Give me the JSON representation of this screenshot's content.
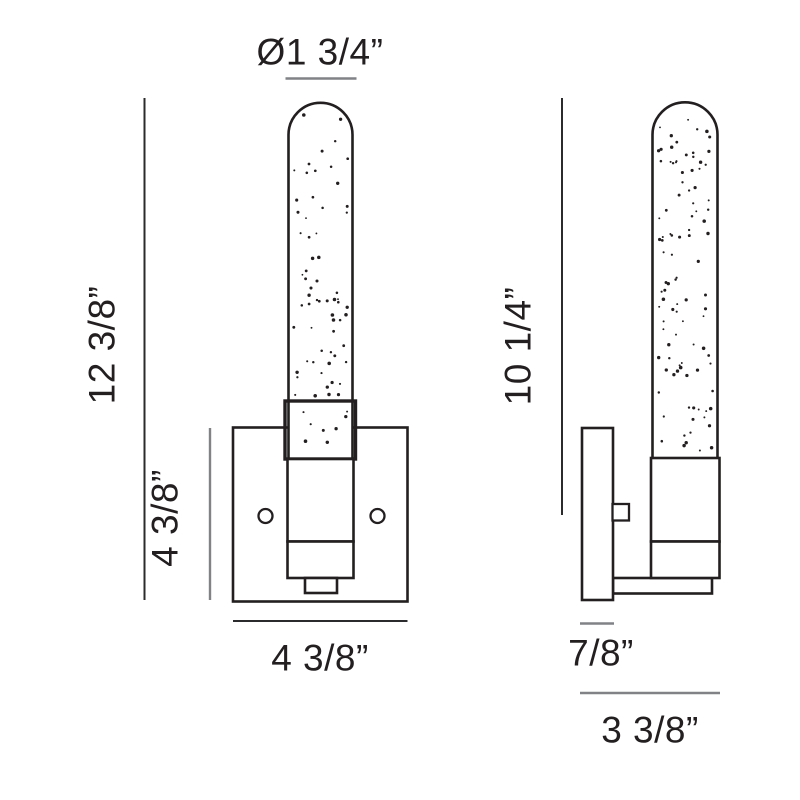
{
  "diagram": {
    "kind": "product-dimension-drawing",
    "subject": "wall-sconce-with-seeded-glass-cylinder",
    "labels": {
      "shade_diameter": "Ø1 3/4”",
      "overall_height": "12 3/8”",
      "backplate_height": "4 3/8”",
      "backplate_width": "4 3/8”",
      "shade_height": "10 1/4”",
      "backplate_depth": "7/8”",
      "overall_depth": "3 3/8”"
    },
    "views": [
      {
        "id": "front-view",
        "position": "left"
      },
      {
        "id": "side-view",
        "position": "right"
      }
    ],
    "colors": {
      "background": "#ffffff",
      "outline": "#231f20",
      "dim_line": "#808285",
      "dim_line_dark": "#2b2b2d",
      "text": "#231f20"
    }
  }
}
